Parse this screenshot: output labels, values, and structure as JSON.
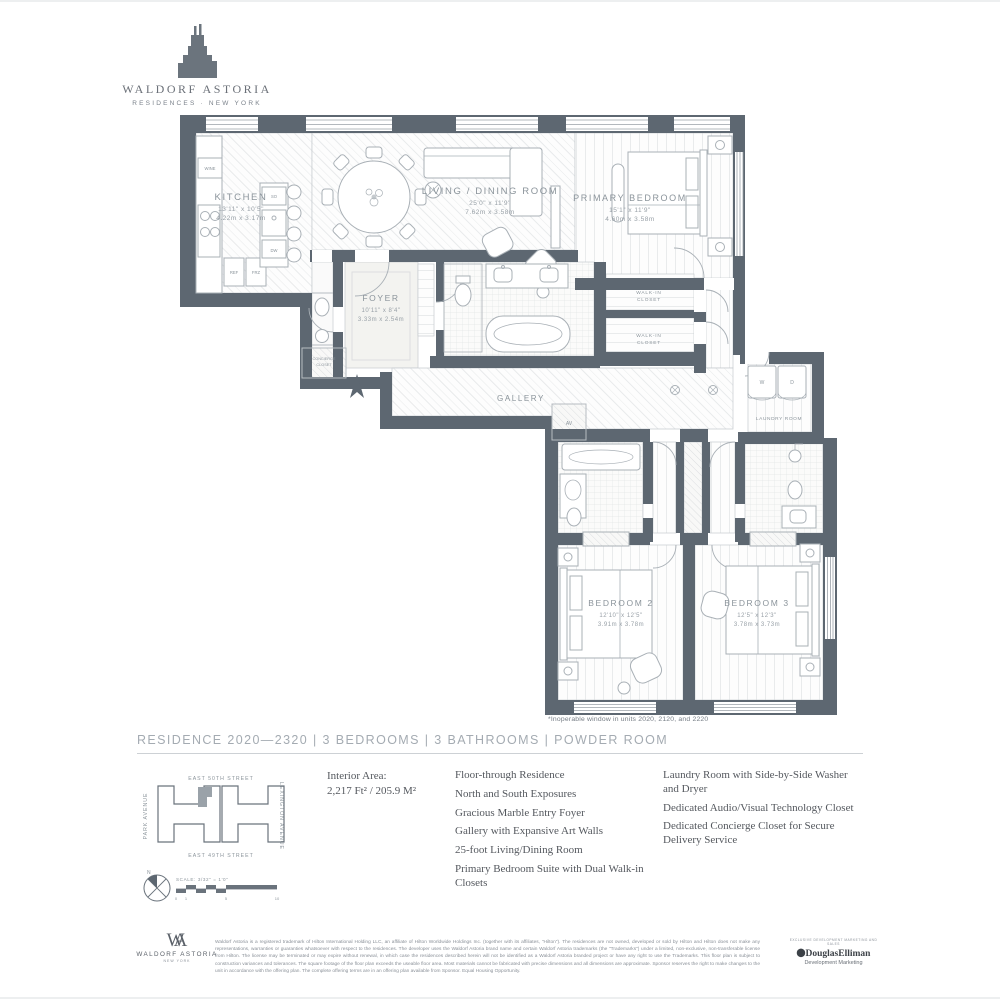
{
  "brand": {
    "name": "WALDORF ASTORIA",
    "subtitle": "RESIDENCES · NEW YORK"
  },
  "page": {
    "title_line": "RESIDENCE 2020—2320 | 3 BEDROOMS | 3 BATHROOMS | POWDER ROOM",
    "footnote": "*Inoperable window in units 2020, 2120, and 2220"
  },
  "plan": {
    "rooms": {
      "kitchen": {
        "name": "KITCHEN",
        "ft": "13'11\" x 10'5\"",
        "m": "4.22m x 3.17m"
      },
      "living": {
        "name": "LIVING / DINING ROOM",
        "ft": "25'0\" x 11'9\"",
        "m": "7.62m x 3.58m"
      },
      "primary": {
        "name": "PRIMARY BEDROOM",
        "ft": "15'1\" x 11'9\"",
        "m": "4.60m x 3.58m"
      },
      "foyer": {
        "name": "FOYER",
        "ft": "10'11\" x 8'4\"",
        "m": "3.33m x 2.54m"
      },
      "gallery": {
        "name": "GALLERY"
      },
      "bed2": {
        "name": "BEDROOM 2",
        "ft": "12'10\" x 12'5\"",
        "m": "3.91m x 3.78m"
      },
      "bed3": {
        "name": "BEDROOM 3",
        "ft": "12'5\" x 12'3\"",
        "m": "3.78m x 3.73m"
      },
      "wic": {
        "l1": "WALK-IN",
        "l2": "CLOSET"
      },
      "laundry": {
        "name": "LAUNDRY ROOM"
      }
    },
    "fixtures": {
      "wine": "WINE",
      "so": "SO",
      "dw": "DW",
      "ref": "REF",
      "frz": "FRZ",
      "av": "AV",
      "washer": "W",
      "dryer": "D",
      "concierge1": "CONCIERGE",
      "concierge2": "CLOSET"
    }
  },
  "details": {
    "interior_area_label": "Interior Area:",
    "interior_area_value": "2,217 Ft² / 205.9 M²",
    "features_col1": [
      "Floor-through Residence",
      "North and South Exposures",
      "Gracious Marble Entry Foyer",
      "Gallery with Expansive Art Walls",
      "25-foot Living/Dining Room",
      "Primary Bedroom Suite with Dual Walk-in Closets"
    ],
    "features_col2": [
      "Laundry Room with Side-by-Side Washer and Dryer",
      "Dedicated Audio/Visual Technology Closet",
      "Dedicated Concierge Closet for Secure Delivery Service"
    ]
  },
  "map": {
    "street_top": "EAST 50TH STREET",
    "street_bottom": "EAST 49TH STREET",
    "avenue_left": "PARK AVENUE",
    "avenue_right": "LEXINGTON AVENUE",
    "north": "N",
    "scale_label": "SCALE: 3/32\" = 1'0\"",
    "ticks": [
      "0",
      "1",
      "5",
      "10"
    ]
  },
  "footer": {
    "monogram_w": "W",
    "monogram_a": "A",
    "brand_name": "WALDORF ASTORIA",
    "brand_city": "NEW YORK",
    "legal": "Waldorf Astoria is a registered trademark of Hilton International Holding LLC, an affiliate of Hilton Worldwide Holdings Inc. (together with its affiliates, \"Hilton\"). The residences are not owned, developed or sold by Hilton and Hilton does not make any representations, warranties or guaranties whatsoever with respect to the residences. The developer uses the Waldorf Astoria brand name and certain Waldorf Astoria trademarks (the \"Trademarks\") under a limited, non-exclusive, non-transferable license from Hilton. The license may be terminated or may expire without renewal, in which case the residences described herein will not be identified as a Waldorf Astoria branded project or have any right to use the Trademarks. This floor plan is subject to construction variances and tolerances. The square footage of the floor plan exceeds the useable floor area. Most materials cannot be fabricated with precise dimensions and all dimensions are approximate. Sponsor reserves the right to make changes to the unit in accordance with the offering plan. The complete offering terms are in an offering plan available from Sponsor. Equal Housing Opportunity.",
    "agent_tagline": "EXCLUSIVE DEVELOPMENT MARKETING AND SALES",
    "agent_name": "DouglasElliman",
    "agent_sub": "Development Marketing"
  },
  "colors": {
    "wall": "#5d6771",
    "furniture_line": "#a9b0b6",
    "label": "#8b949b"
  }
}
